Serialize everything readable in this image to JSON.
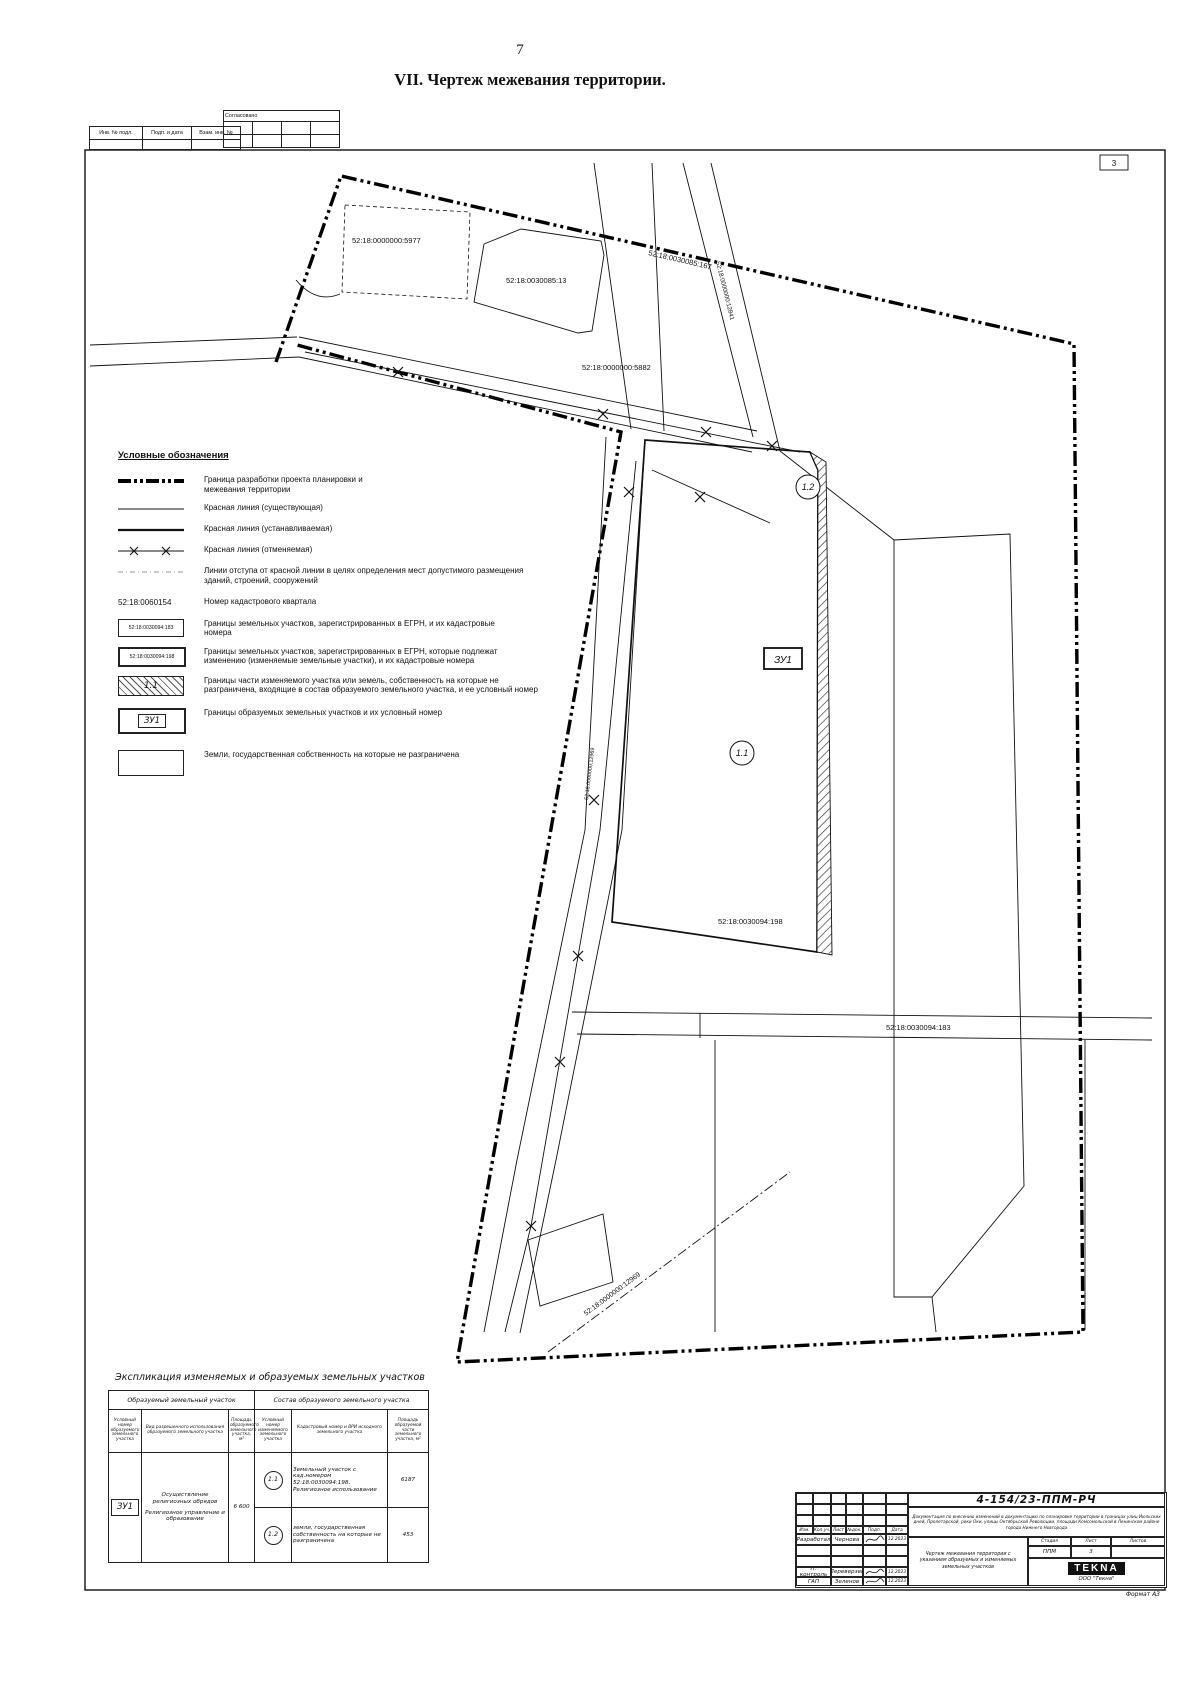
{
  "page": {
    "number": "7",
    "title": "VII.  Чертеж межевания территории.",
    "sheet_corner": "3",
    "format_label": "Формат А3"
  },
  "stamp": {
    "col1": "Инв. № подл.",
    "col2": "Подп. и дата",
    "col3": "Взам. инв. №",
    "approved": "Согласовано"
  },
  "legend": {
    "heading": "Условные обозначения",
    "items": [
      {
        "label": "Граница разработки проекта планировки и межевания территории"
      },
      {
        "label": "Красная линия (существующая)"
      },
      {
        "label": "Красная линия (устанавливаемая)"
      },
      {
        "label": "Красная линия (отменяемая)"
      },
      {
        "label": "Линии отступа от красной линии в целях определения мест допустимого размещения зданий, строений, сооружений"
      },
      {
        "sym": "52:18:0060154",
        "label": "Номер кадастрового квартала"
      },
      {
        "sym": "52:18:0030094:183",
        "label": "Границы земельных участков, зарегистрированных в  ЕГРН, и их кадастровые номера"
      },
      {
        "sym": "52:18:0030094:198",
        "label": "Границы земельных участков, зарегистрированных в ЕГРН, которые подлежат изменению (изменяемые земельные участки), и их кадастровые номера"
      },
      {
        "sym": "1.1",
        "label": "Границы части изменяемого участка или земель, собственность на которые не разграничена, входящие в состав образуемого земельного участка, и ее условный номер"
      },
      {
        "sym": "ЗУ1",
        "label": "Границы образуемых земельных участков и их условный номер"
      },
      {
        "label": "Земли, государственная собственность на которые не разграничена"
      }
    ]
  },
  "map": {
    "labels": {
      "p5977": "52:18:0000000:5977",
      "p13": "52:18:0030085:13",
      "p167": "52:18:0030085:167",
      "p12841": "52:18:0000000:12841",
      "p5882": "52:18:0000000:5882",
      "p198": "52:18:0030094:198",
      "p183": "52:18:0030094:183",
      "p12969": "52:18:0000000:12969",
      "road": "52:18:0000000:12969",
      "c11": "1.1",
      "c12": "1.2",
      "zu1": "ЗУ1"
    }
  },
  "expl": {
    "title": "Экспликация изменяемых и образуемых  земельных участков",
    "group1": "Образуемый земельный участок",
    "group2": "Состав образуемого земельного участка",
    "headers": [
      "Условный номер образуемого земельного участка",
      "Вид разрешенного использования образуемого земельного участка",
      "Площадь образуемого земельного участка, м²",
      "Условный номер изменяемого земельного участка",
      "Кадастровый номер и ВРИ исходного земельного участка",
      "Площадь образуемой части земельного участка, м²"
    ],
    "zu": "ЗУ1",
    "usage1": "Осуществление религиозных обрядов",
    "usage2": "Религиозное управление и образование",
    "area": "6 600",
    "rows": [
      {
        "num": "1.1",
        "desc": "Земельный участок с кад.номером 52:18:0030094:198. Религиозное использование",
        "area": "6187"
      },
      {
        "num": "1.2",
        "desc": "земли, государственная собственность на которые не разграничена",
        "area": "453"
      }
    ]
  },
  "tb": {
    "num": "4-154/23-ППМ-РЧ",
    "desc": "Документация по внесению изменений в документацию по планировке территории в границах улиц Июльских дней, Пролетарской, реки Оки, улицы Октябрьской Революции, площади Комсомольской в Ленинском районе города Нижнего Новгорода",
    "sheet_title": "Чертеж межевания территории с указанием образуемых и изменяемых земельных участков",
    "cols": [
      "Изм.",
      "Кол.уч.",
      "Лист",
      "№док.",
      "Подп.",
      "Дата"
    ],
    "r1role": "Разработал",
    "r1name": "Чернова",
    "r1date": "12.2023",
    "r2role": "Н. контроль",
    "r2name": "Переверзев",
    "r2date": "12.2023",
    "r3role": "ГАП",
    "r3name": "Зеленов",
    "r3date": "12.2023",
    "stage_l": "Стадия",
    "sheet_l": "Лист",
    "sheets_l": "Листов",
    "stage": "ППМ",
    "sheet": "3",
    "logo": "TEKNA",
    "company": "ООО \"Текна\""
  }
}
